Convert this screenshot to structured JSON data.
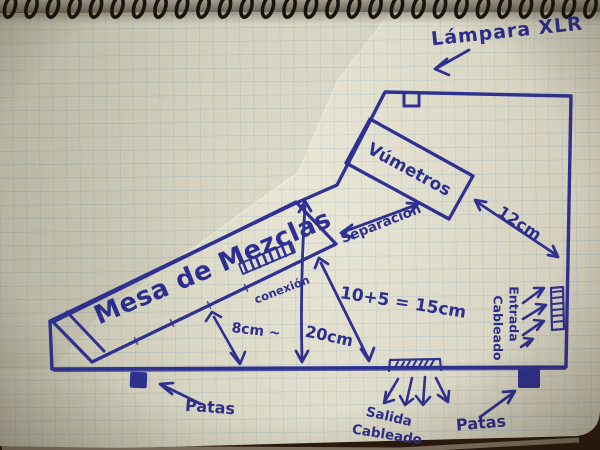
{
  "sketch": {
    "description": "hand-drawn plan of a mixing desk case on squared notebook paper",
    "objects": {
      "mixer": "Mesa de Mezclas",
      "vumeters": "Vúmetros",
      "lamp": "Lámpara XLR",
      "connection": "conexión",
      "separation": "Separación",
      "feet_left": "Patas",
      "feet_right": "Patas",
      "outlet": [
        "Salida",
        "Cableado"
      ],
      "inlet": [
        "Entrada",
        "Cableado"
      ]
    },
    "dimensions": {
      "right_gap": "12cm",
      "sum": "10+5 = 15cm",
      "height": "20cm",
      "under_desk": "8cm ~"
    },
    "colors": {
      "pen": "#2f3295",
      "paper": "#eae6d4",
      "grid": "#8fb8c9",
      "table": "#3a2112"
    }
  }
}
